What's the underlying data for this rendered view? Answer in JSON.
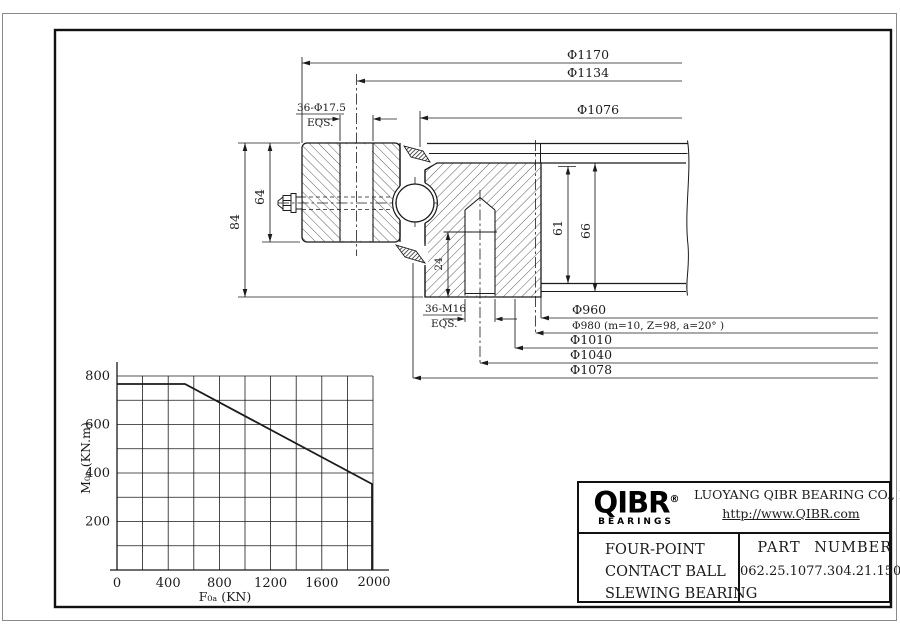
{
  "drawing": {
    "dims_top": [
      "Φ1170",
      "Φ1134",
      "Φ1076"
    ],
    "outer_bolt_label": "36-Φ17.5",
    "outer_bolt_note": "EQS.",
    "inner_bolt_label": "36-M16",
    "inner_bolt_note": "EQS.",
    "height_total": "84",
    "height_outer_ring": "64",
    "height_gear": "61",
    "height_inner_ring": "66",
    "thread_depth": "24",
    "dims_bottom": [
      "Φ960",
      "Φ980  (m=10, Z=98, a=20° )",
      "Φ1010",
      "Φ1040",
      "Φ1078"
    ]
  },
  "chart_data": {
    "type": "line",
    "title": "Static limiting load curve",
    "xlabel": "F₀ₐ (KN)",
    "ylabel": "M₀ₐ (KN.m)",
    "xlim": [
      0,
      2100
    ],
    "ylim": [
      0,
      800
    ],
    "x_ticks": [
      "0",
      "400",
      "800",
      "1200",
      "1600",
      "2000"
    ],
    "y_ticks": [
      "200",
      "400",
      "600",
      "800"
    ],
    "grid": "on",
    "legend": "none",
    "series": [
      {
        "name": "axial load vs tilting moment limit",
        "points": [
          [
            0,
            770
          ],
          [
            530,
            770
          ],
          [
            2000,
            355
          ],
          [
            2000,
            0
          ]
        ]
      }
    ]
  },
  "title_block": {
    "logo_text": "QIBR",
    "logo_reg": "®",
    "logo_sub": "BEARINGS",
    "company": "LUOYANG QIBR BEARING CO., LTD",
    "website": "http://www.QIBR.com",
    "product_line1": "FOUR-POINT",
    "product_line2": "CONTACT BALL",
    "product_line3": "SLEWING BEARING",
    "part_number_label": "PART NUMBER",
    "part_number": "062.25.1077.304.21.1504"
  }
}
